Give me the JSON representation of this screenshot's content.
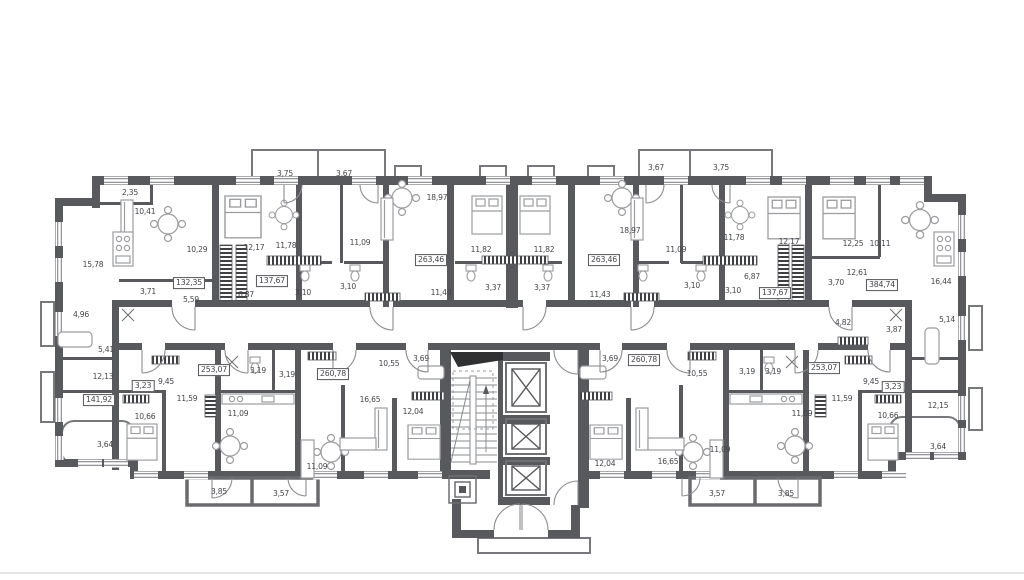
{
  "floorplan": {
    "type": "residential-floor-plan",
    "colors": {
      "wall": "#58595c",
      "thin_line": "#8a8b8e",
      "text": "#45464a",
      "hatch": "#3f4043"
    },
    "labels": [
      {
        "text": "3,75",
        "x": 285,
        "y": 174,
        "boxed": false
      },
      {
        "text": "3,67",
        "x": 344,
        "y": 174,
        "boxed": false
      },
      {
        "text": "3,67",
        "x": 656,
        "y": 168,
        "boxed": false
      },
      {
        "text": "3,75",
        "x": 721,
        "y": 168,
        "boxed": false
      },
      {
        "text": "2,35",
        "x": 130,
        "y": 193,
        "boxed": false
      },
      {
        "text": "10,41",
        "x": 145,
        "y": 212,
        "boxed": false
      },
      {
        "text": "15,78",
        "x": 93,
        "y": 265,
        "boxed": false
      },
      {
        "text": "10,29",
        "x": 197,
        "y": 250,
        "boxed": false
      },
      {
        "text": "12,17",
        "x": 254,
        "y": 248,
        "boxed": false
      },
      {
        "text": "11,78",
        "x": 286,
        "y": 246,
        "boxed": false
      },
      {
        "text": "132,35",
        "x": 189,
        "y": 283,
        "boxed": true
      },
      {
        "text": "137,67",
        "x": 272,
        "y": 281,
        "boxed": true
      },
      {
        "text": "3,71",
        "x": 148,
        "y": 292,
        "boxed": false
      },
      {
        "text": "5,59",
        "x": 191,
        "y": 300,
        "boxed": false
      },
      {
        "text": "6,87",
        "x": 246,
        "y": 295,
        "boxed": false
      },
      {
        "text": "4,96",
        "x": 81,
        "y": 315,
        "boxed": false
      },
      {
        "text": "11,09",
        "x": 360,
        "y": 243,
        "boxed": false
      },
      {
        "text": "18,97",
        "x": 437,
        "y": 198,
        "boxed": false
      },
      {
        "text": "263,46",
        "x": 431,
        "y": 260,
        "boxed": true
      },
      {
        "text": "3,10",
        "x": 303,
        "y": 293,
        "boxed": false
      },
      {
        "text": "3,10",
        "x": 348,
        "y": 287,
        "boxed": false
      },
      {
        "text": "11,43",
        "x": 441,
        "y": 293,
        "boxed": false
      },
      {
        "text": "3,37",
        "x": 493,
        "y": 288,
        "boxed": false
      },
      {
        "text": "11,82",
        "x": 481,
        "y": 250,
        "boxed": false
      },
      {
        "text": "11,82",
        "x": 544,
        "y": 250,
        "boxed": false
      },
      {
        "text": "3,37",
        "x": 542,
        "y": 288,
        "boxed": false
      },
      {
        "text": "18,97",
        "x": 630,
        "y": 231,
        "boxed": false
      },
      {
        "text": "263,46",
        "x": 604,
        "y": 260,
        "boxed": true
      },
      {
        "text": "11,43",
        "x": 600,
        "y": 295,
        "boxed": false
      },
      {
        "text": "11,09",
        "x": 676,
        "y": 250,
        "boxed": false
      },
      {
        "text": "3,10",
        "x": 692,
        "y": 286,
        "boxed": false
      },
      {
        "text": "3,10",
        "x": 733,
        "y": 291,
        "boxed": false
      },
      {
        "text": "6,87",
        "x": 752,
        "y": 277,
        "boxed": false
      },
      {
        "text": "11,78",
        "x": 734,
        "y": 238,
        "boxed": false
      },
      {
        "text": "12,17",
        "x": 789,
        "y": 242,
        "boxed": false
      },
      {
        "text": "12,25",
        "x": 853,
        "y": 244,
        "boxed": false
      },
      {
        "text": "10,11",
        "x": 880,
        "y": 244,
        "boxed": false
      },
      {
        "text": "137,67",
        "x": 775,
        "y": 293,
        "boxed": true
      },
      {
        "text": "3,70",
        "x": 836,
        "y": 283,
        "boxed": false
      },
      {
        "text": "12,61",
        "x": 857,
        "y": 273,
        "boxed": false
      },
      {
        "text": "384,74",
        "x": 882,
        "y": 285,
        "boxed": true
      },
      {
        "text": "16,44",
        "x": 941,
        "y": 282,
        "boxed": false
      },
      {
        "text": "4,82",
        "x": 843,
        "y": 323,
        "boxed": false
      },
      {
        "text": "3,87",
        "x": 894,
        "y": 330,
        "boxed": false
      },
      {
        "text": "5,14",
        "x": 947,
        "y": 320,
        "boxed": false
      },
      {
        "text": "5,41",
        "x": 106,
        "y": 350,
        "boxed": false
      },
      {
        "text": "12,13",
        "x": 103,
        "y": 377,
        "boxed": false
      },
      {
        "text": "141,92",
        "x": 99,
        "y": 400,
        "boxed": true
      },
      {
        "text": "3,64",
        "x": 105,
        "y": 445,
        "boxed": false
      },
      {
        "text": "10,66",
        "x": 145,
        "y": 417,
        "boxed": false
      },
      {
        "text": "3,23",
        "x": 143,
        "y": 386,
        "boxed": true
      },
      {
        "text": "9,45",
        "x": 166,
        "y": 382,
        "boxed": false
      },
      {
        "text": "11,59",
        "x": 187,
        "y": 399,
        "boxed": false
      },
      {
        "text": "253,07",
        "x": 214,
        "y": 370,
        "boxed": true
      },
      {
        "text": "3,19",
        "x": 258,
        "y": 371,
        "boxed": false
      },
      {
        "text": "3,19",
        "x": 287,
        "y": 375,
        "boxed": false
      },
      {
        "text": "11,09",
        "x": 238,
        "y": 414,
        "boxed": false
      },
      {
        "text": "3,85",
        "x": 219,
        "y": 492,
        "boxed": false
      },
      {
        "text": "3,57",
        "x": 281,
        "y": 494,
        "boxed": false
      },
      {
        "text": "260,78",
        "x": 333,
        "y": 374,
        "boxed": true
      },
      {
        "text": "10,55",
        "x": 389,
        "y": 364,
        "boxed": false
      },
      {
        "text": "3,69",
        "x": 421,
        "y": 359,
        "boxed": false
      },
      {
        "text": "16,65",
        "x": 370,
        "y": 400,
        "boxed": false
      },
      {
        "text": "12,04",
        "x": 413,
        "y": 412,
        "boxed": false
      },
      {
        "text": "11,09",
        "x": 317,
        "y": 467,
        "boxed": false
      },
      {
        "text": "3,69",
        "x": 610,
        "y": 359,
        "boxed": false
      },
      {
        "text": "260,78",
        "x": 644,
        "y": 360,
        "boxed": true
      },
      {
        "text": "10,55",
        "x": 697,
        "y": 374,
        "boxed": false
      },
      {
        "text": "3,19",
        "x": 747,
        "y": 372,
        "boxed": false
      },
      {
        "text": "3,19",
        "x": 773,
        "y": 372,
        "boxed": false
      },
      {
        "text": "12,04",
        "x": 605,
        "y": 464,
        "boxed": false
      },
      {
        "text": "16,65",
        "x": 668,
        "y": 462,
        "boxed": false
      },
      {
        "text": "11,09",
        "x": 720,
        "y": 450,
        "boxed": false
      },
      {
        "text": "3,57",
        "x": 717,
        "y": 494,
        "boxed": false
      },
      {
        "text": "3,85",
        "x": 786,
        "y": 494,
        "boxed": false
      },
      {
        "text": "253,07",
        "x": 824,
        "y": 368,
        "boxed": true
      },
      {
        "text": "9,45",
        "x": 871,
        "y": 382,
        "boxed": false
      },
      {
        "text": "3,23",
        "x": 893,
        "y": 387,
        "boxed": true
      },
      {
        "text": "11,59",
        "x": 842,
        "y": 399,
        "boxed": false
      },
      {
        "text": "11,09",
        "x": 802,
        "y": 414,
        "boxed": false
      },
      {
        "text": "10,66",
        "x": 888,
        "y": 416,
        "boxed": false
      },
      {
        "text": "12,15",
        "x": 938,
        "y": 406,
        "boxed": false
      },
      {
        "text": "3,64",
        "x": 938,
        "y": 447,
        "boxed": false
      }
    ]
  }
}
